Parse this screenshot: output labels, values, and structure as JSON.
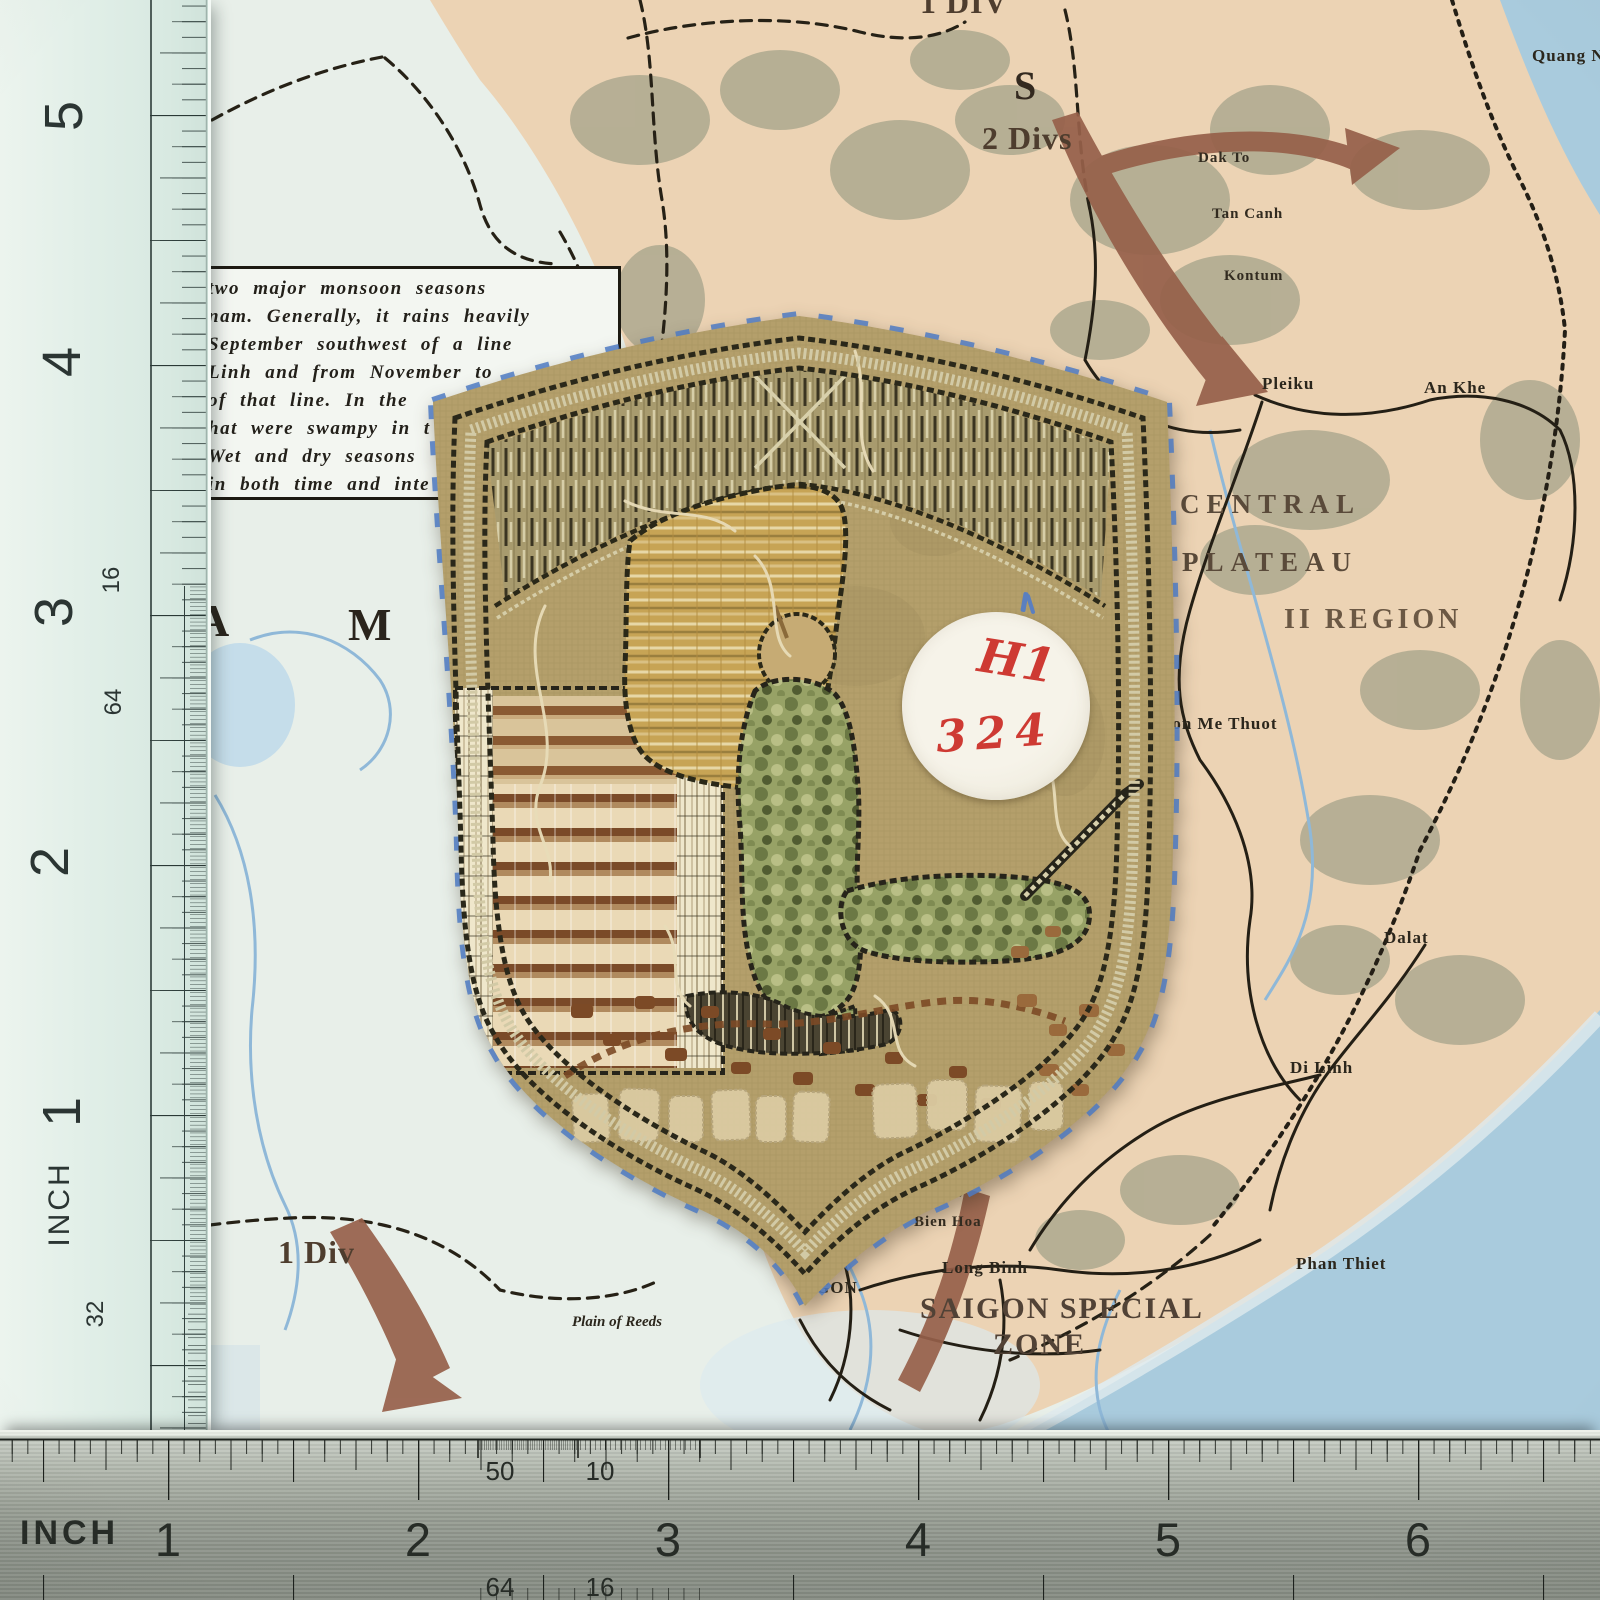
{
  "photo_subject": "embroidered shield patch (reverse side) on Vietnam war map with two inch rulers",
  "sticker": {
    "line1": "H1",
    "line2": "324",
    "ink_color": "#ce3a33",
    "background": "#f4f1e6"
  },
  "left_ruler": {
    "unit_label": "INCH",
    "numbers": [
      {
        "label": "5"
      },
      {
        "label": "4"
      },
      {
        "label": "3"
      },
      {
        "label": "2"
      },
      {
        "label": "1"
      }
    ],
    "scale_labels": [
      {
        "label": "16"
      },
      {
        "label": "64"
      },
      {
        "label": "32"
      }
    ]
  },
  "bottom_ruler": {
    "unit_label": "INCH",
    "numbers": [
      {
        "label": "1"
      },
      {
        "label": "2"
      },
      {
        "label": "3"
      },
      {
        "label": "4"
      },
      {
        "label": "5"
      },
      {
        "label": "6"
      }
    ],
    "scale_labels_top": [
      {
        "label": "50"
      },
      {
        "label": "10"
      }
    ],
    "scale_labels_bottom": [
      {
        "label": "64"
      },
      {
        "label": "16"
      }
    ]
  },
  "map": {
    "labels": [
      {
        "id": "div-top",
        "text": "1 DIV"
      },
      {
        "id": "letter-s",
        "text": "S"
      },
      {
        "id": "two-divs",
        "text": "2 Divs"
      },
      {
        "id": "dak-to",
        "text": "Dak To"
      },
      {
        "id": "tan-canh",
        "text": "Tan Canh"
      },
      {
        "id": "kontum",
        "text": "Kontum"
      },
      {
        "id": "quang-ngai",
        "text": "Quang Ngai"
      },
      {
        "id": "pleiku",
        "text": "Pleiku"
      },
      {
        "id": "an-khe",
        "text": "An Khe"
      },
      {
        "id": "central",
        "text": "CENTRAL"
      },
      {
        "id": "plateau",
        "text": "PLATEAU"
      },
      {
        "id": "ii-region",
        "text": "II REGION"
      },
      {
        "id": "bon-me-thuot",
        "text": "Bon Me Thuot"
      },
      {
        "id": "dalat",
        "text": "Dalat"
      },
      {
        "id": "di-linh",
        "text": "Di Linh"
      },
      {
        "id": "phan-thiet",
        "text": "Phan Thiet"
      },
      {
        "id": "one-div",
        "text": "1 Div"
      },
      {
        "id": "long-binh",
        "text": "Long Binh"
      },
      {
        "id": "saigon-special",
        "text": "SAIGON SPECIAL"
      },
      {
        "id": "zone",
        "text": "ZONE"
      },
      {
        "id": "gon",
        "text": "GON"
      },
      {
        "id": "bien-hoa",
        "text": "Bien Hoa"
      },
      {
        "id": "plain-of-reeds",
        "text": "Plain of Reeds"
      },
      {
        "id": "letter-a",
        "text": "A"
      },
      {
        "id": "letter-m",
        "text": "M"
      }
    ],
    "monsoon_box_lines": [
      "two major monsoon seasons",
      "nam.  Generally, it rains heavily",
      "September southwest of a line",
      "Linh and from November to",
      "of that line.  In the",
      "hat were swampy in t",
      "Wet and dry seasons",
      "in both time and inte"
    ],
    "colors": {
      "sea": "#a9cbdd",
      "land": "#ecd3b4",
      "terrain": "#a8a58c",
      "arrow": "#96604a",
      "road": "#241f15",
      "river": "#8fb8d8"
    }
  },
  "patch": {
    "fabric_color": "#b49f6b",
    "stitch_color": "#2a281a",
    "backing_thread_color": "#4d7ac2",
    "note": "reverse side; embroidery text mirrored and illegible"
  }
}
